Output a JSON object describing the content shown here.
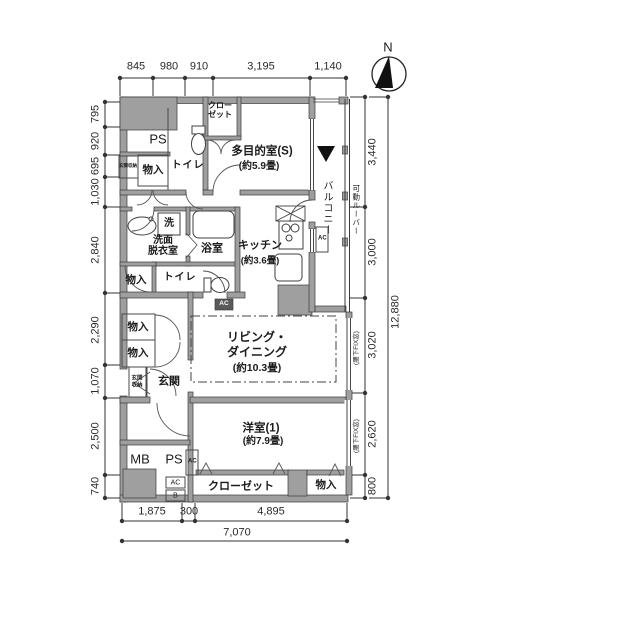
{
  "compass": {
    "north": "N"
  },
  "rooms": {
    "multipurpose_name": "多目的室(S)",
    "multipurpose_size": "(約5.9畳)",
    "kitchen_name": "キッチン",
    "kitchen_size": "(約3.6畳)",
    "living_name1": "リビング・",
    "living_name2": "ダイニング",
    "living_size": "(約10.3畳)",
    "western_name": "洋室(1)",
    "western_size": "(約7.9畳)",
    "bathroom": "浴室",
    "washroom1": "洗面",
    "washroom2": "脱衣室",
    "toilet": "トイレ",
    "entrance": "玄関",
    "entrance_storage": "玄関収納",
    "balcony": "バルコニー",
    "movable_louver": "可動ルーバー",
    "closet_top1": "クロー",
    "closet_top2": "ゼット",
    "closet_bottom": "クローゼット",
    "storage": "物入",
    "washer": "洗"
  },
  "equipment": {
    "ps": "PS",
    "mb": "MB",
    "ac": "AC",
    "b": "B"
  },
  "dimensions": {
    "top": [
      "845",
      "980",
      "910",
      "3,195",
      "1,140"
    ],
    "bottom": [
      "1,875",
      "300",
      "4,895"
    ],
    "bottom_total": "7,070",
    "left": [
      "795",
      "920",
      "695",
      "1,030",
      "2,840",
      "2,290",
      "1,070",
      "2,500",
      "740"
    ],
    "right": [
      "3,440",
      "3,000",
      "3,020",
      "2,620",
      "800"
    ],
    "right_total": "12,880",
    "window_note": "(腰下FIX窓)"
  }
}
